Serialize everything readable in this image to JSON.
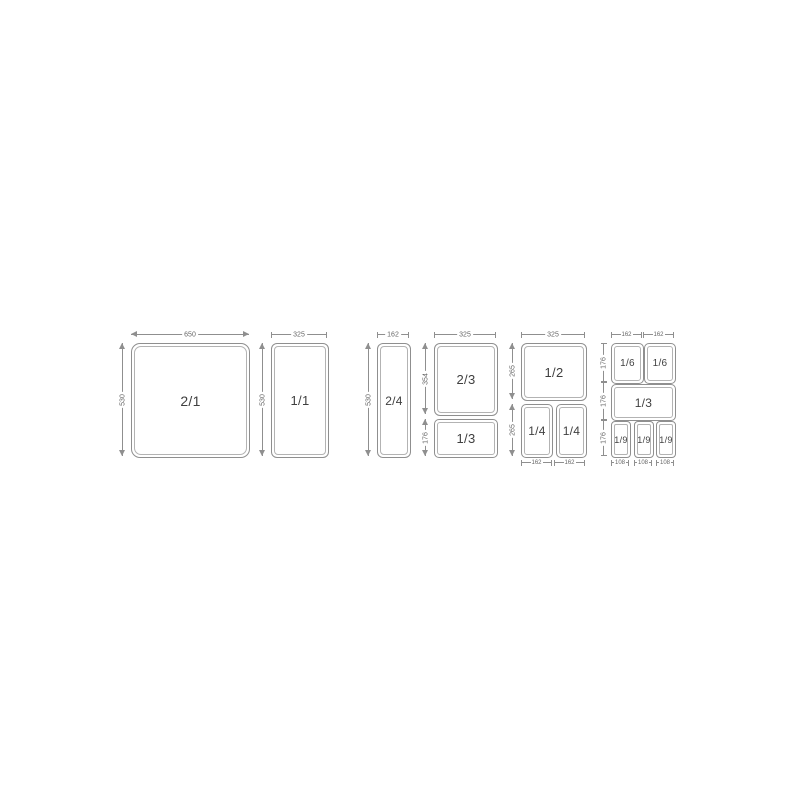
{
  "diagram_title": "gastronorm-pan-sizes",
  "colors": {
    "background": "#ffffff",
    "outline": "#8f8f8f",
    "inner_rim": "#b3b3b3",
    "pan_label": "#3f3f3f",
    "dim_label": "#666666"
  },
  "panels": {
    "p1": {
      "label": "2/1",
      "top": "650",
      "left": "530"
    },
    "p2": {
      "label": "1/1",
      "top": "325",
      "left": "530"
    },
    "p3": {
      "label": "2/4",
      "top": "162",
      "left": "530"
    },
    "p4": {
      "top": "325",
      "upper": {
        "label": "2/3",
        "left": "354"
      },
      "lower": {
        "label": "1/3",
        "left": "176"
      }
    },
    "p5": {
      "top": "325",
      "upper": {
        "label": "1/2",
        "left": "265"
      },
      "lower_left": {
        "label": "1/4"
      },
      "lower_right": {
        "label": "1/4"
      },
      "lower_height": "265",
      "bottom": [
        "162",
        "162"
      ]
    },
    "p6": {
      "top": [
        "162",
        "162"
      ],
      "row_heights": [
        "176",
        "176",
        "176"
      ],
      "r1": [
        "1/6",
        "1/6"
      ],
      "r2": "1/3",
      "r3": [
        "1/9",
        "1/9",
        "1/9"
      ],
      "bottom": [
        "108",
        "108",
        "108"
      ]
    }
  }
}
